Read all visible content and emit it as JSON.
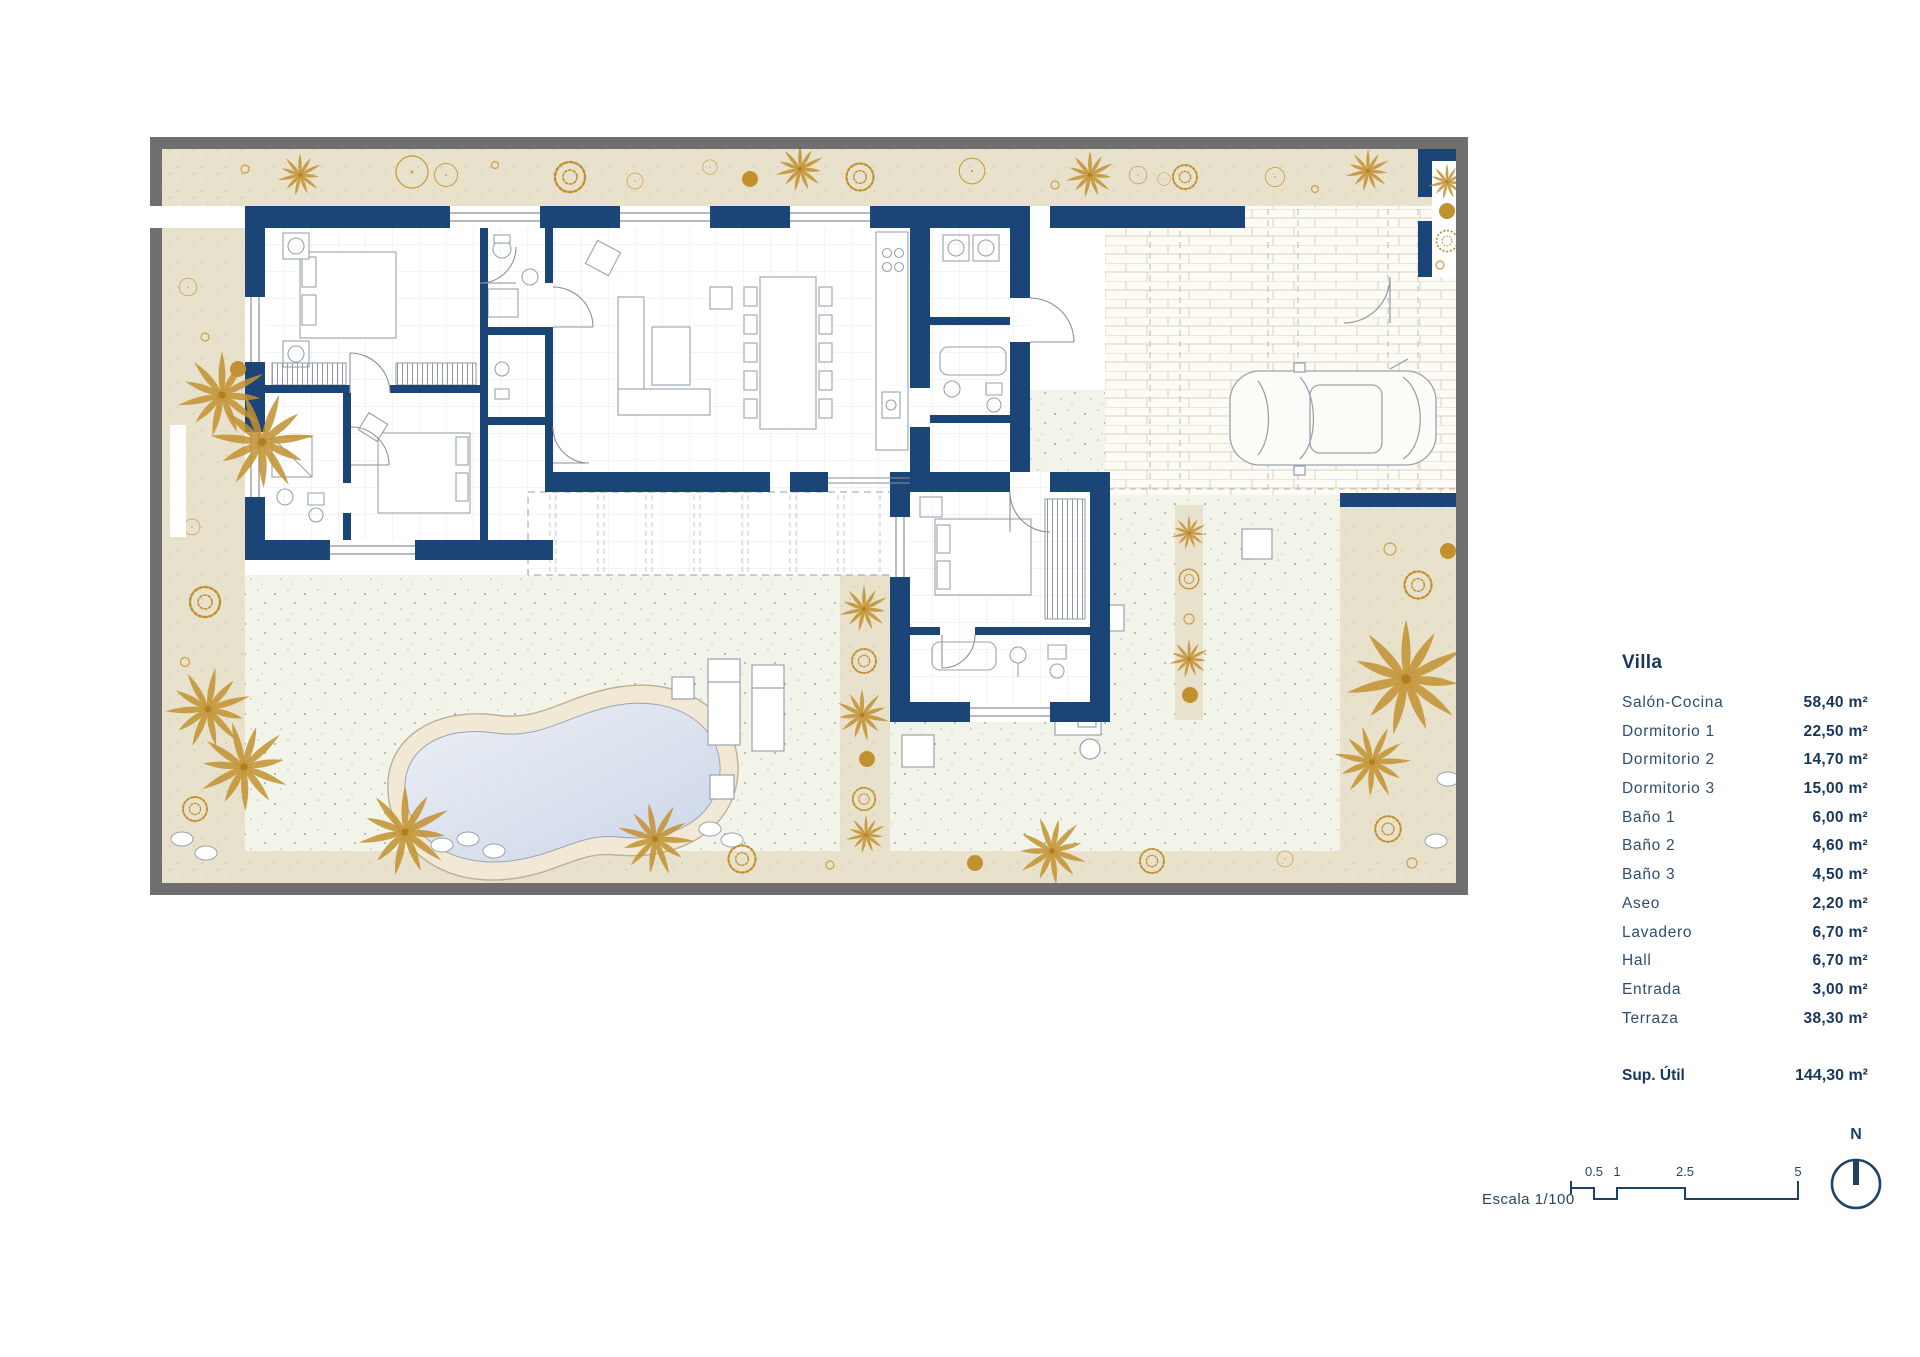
{
  "legend": {
    "title": "Villa",
    "rooms": [
      {
        "label": "Salón-Cocina",
        "area": "58,40 m²"
      },
      {
        "label": "Dormitorio 1",
        "area": "22,50 m²"
      },
      {
        "label": "Dormitorio 2",
        "area": "14,70 m²"
      },
      {
        "label": "Dormitorio 3",
        "area": "15,00 m²"
      },
      {
        "label": "Baño 1",
        "area": "6,00 m²"
      },
      {
        "label": "Baño 2",
        "area": "4,60 m²"
      },
      {
        "label": "Baño 3",
        "area": "4,50 m²"
      },
      {
        "label": "Aseo",
        "area": "2,20 m²"
      },
      {
        "label": "Lavadero",
        "area": "6,70 m²"
      },
      {
        "label": "Hall",
        "area": "6,70 m²"
      },
      {
        "label": "Entrada",
        "area": "3,00 m²"
      },
      {
        "label": "Terraza",
        "area": "38,30 m²"
      }
    ],
    "total_label": "Sup. Útil",
    "total_area": "144,30 m²"
  },
  "scale": {
    "label": "Escala 1/100",
    "ticks": [
      "0.5",
      "1",
      "2.5",
      "5"
    ]
  },
  "north": {
    "label": "N"
  },
  "colors": {
    "wall_navy": "#1c4577",
    "plot_border_gray": "#6f6f6f",
    "garden_beige": "#e8e1cc",
    "vegetation_gold": "#c2912f",
    "terrace_pale": "#f2f4ea",
    "pool_sand": "#f2e8d6",
    "pool_water": "#ccd6e8",
    "text_navy": "#16365c"
  }
}
